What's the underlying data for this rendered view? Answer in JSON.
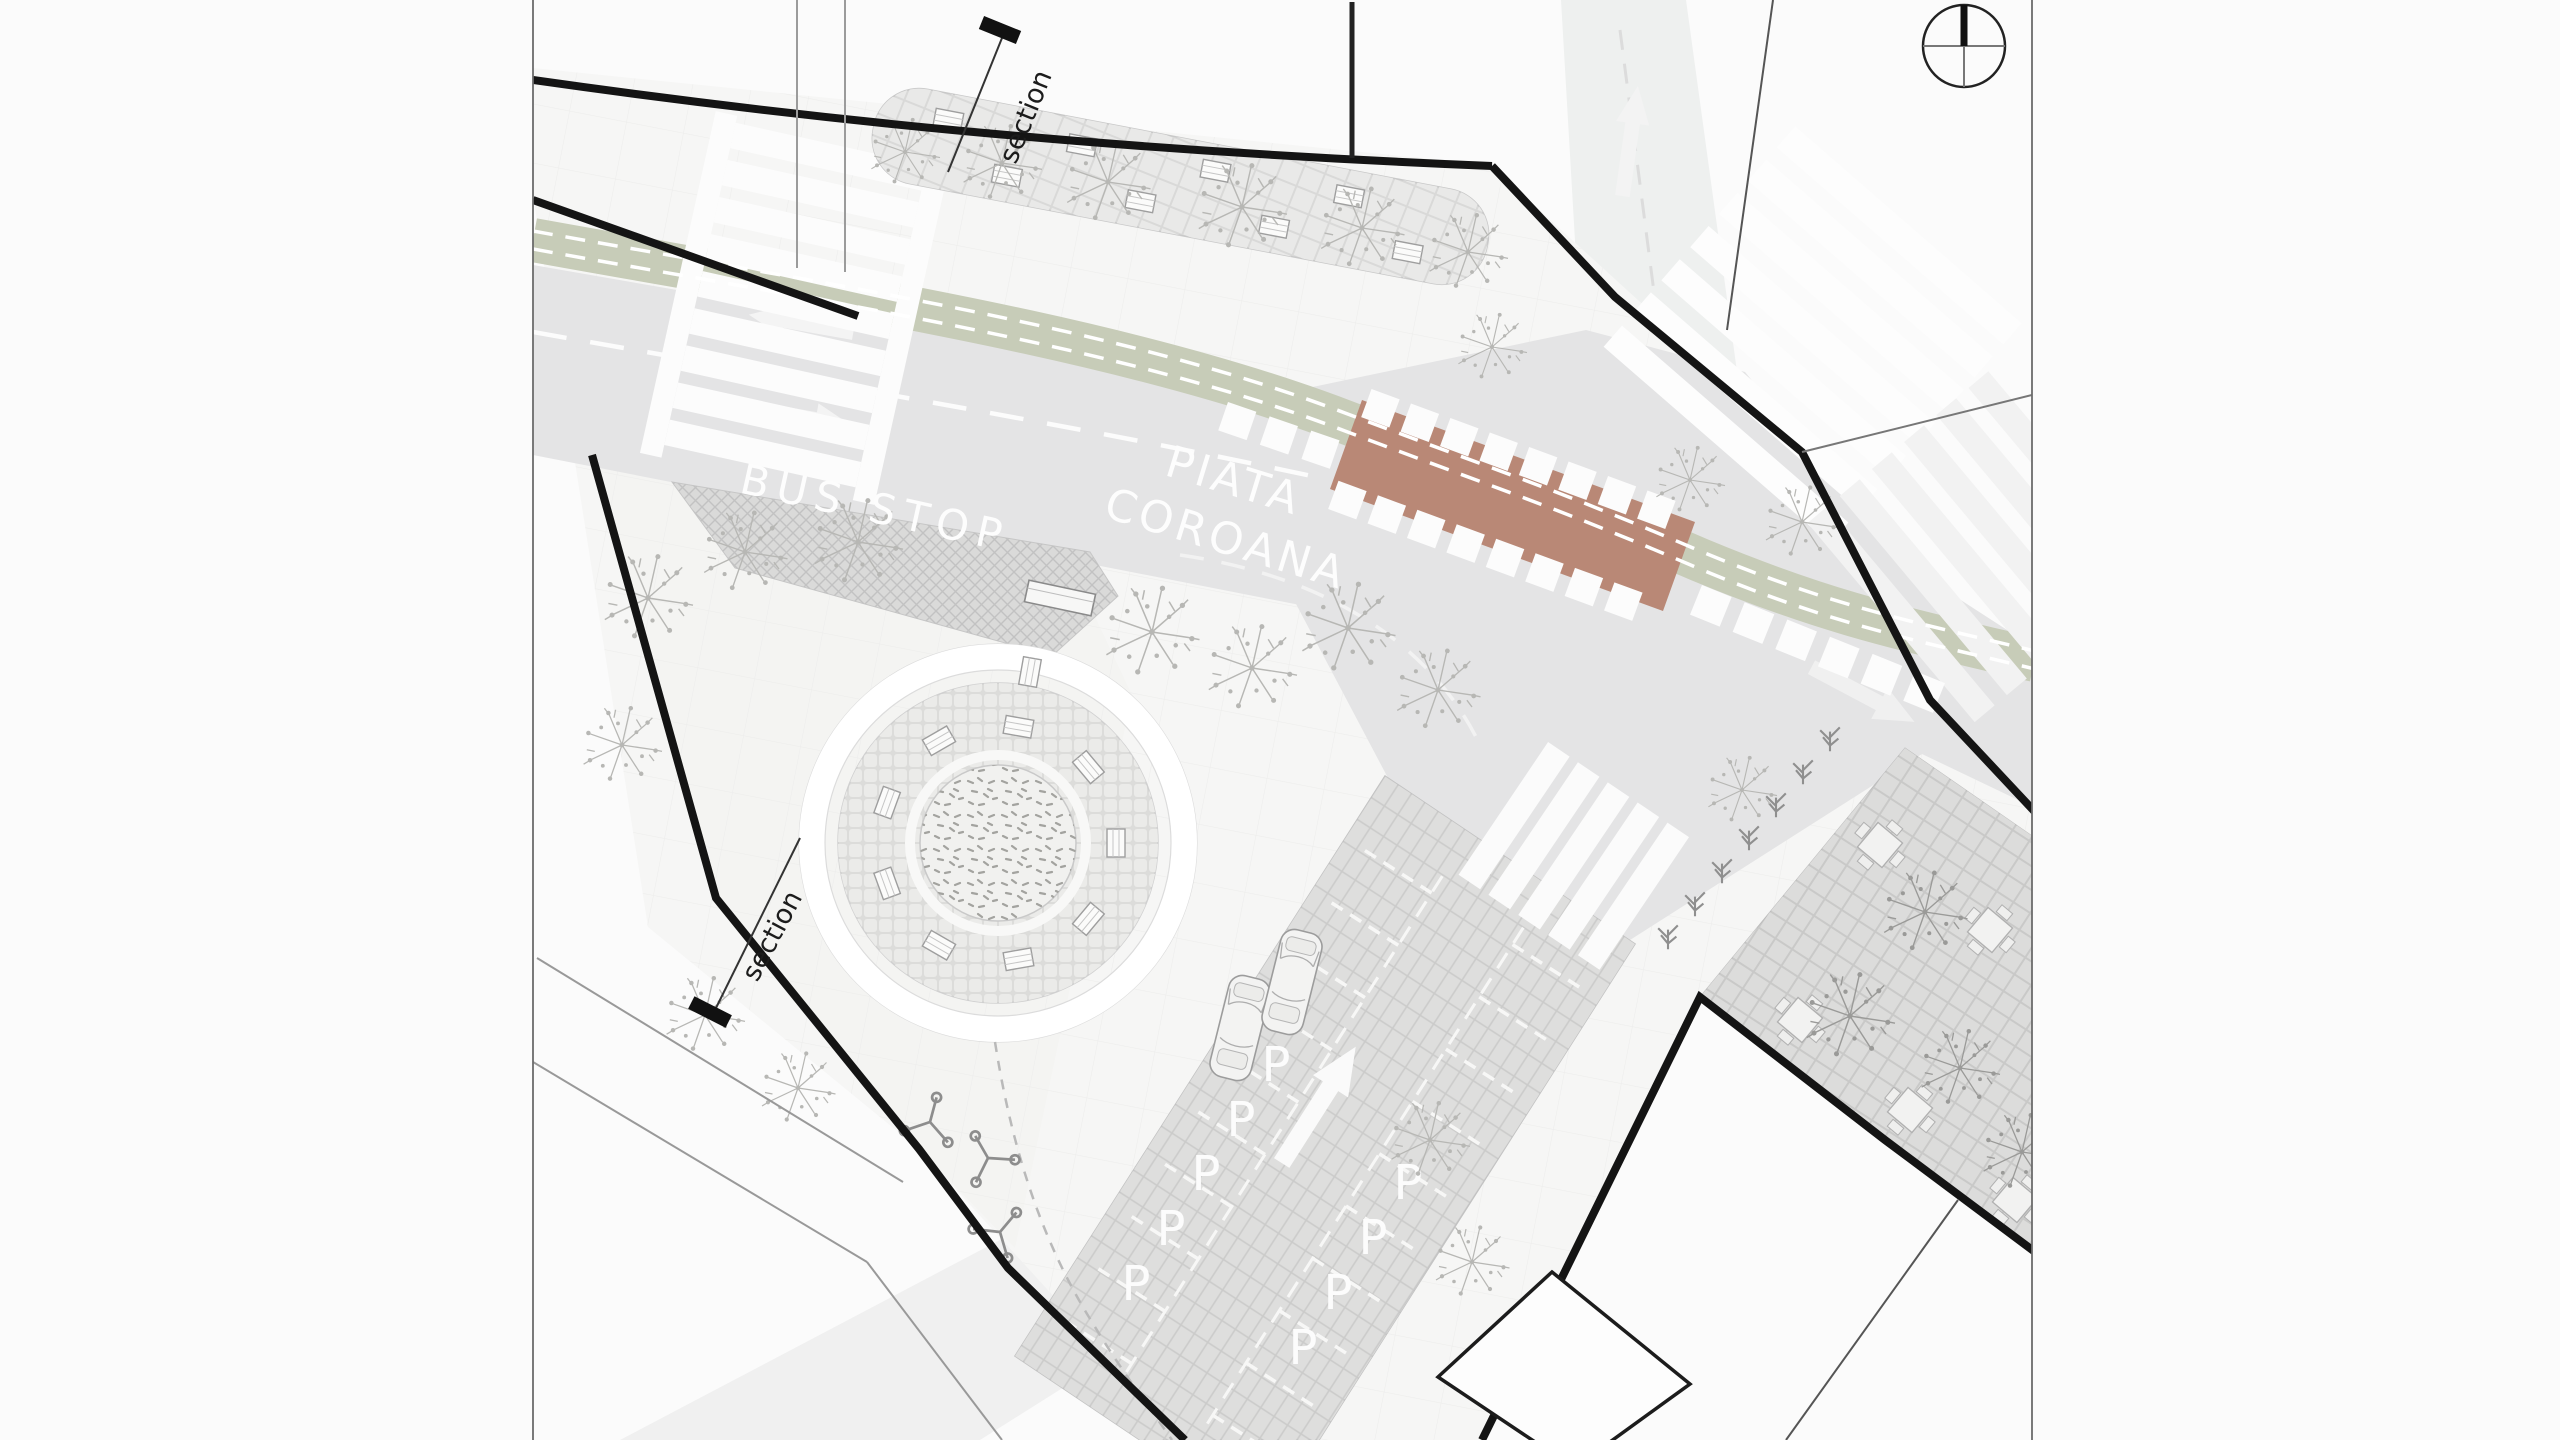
{
  "plan": {
    "labels": {
      "square_line1": "PIATA",
      "square_line2": "COROANA",
      "bus_stop": "BUS STOP",
      "parking_space": "P"
    },
    "section_markers": [
      {
        "label": "section"
      },
      {
        "label": "section"
      }
    ],
    "parking": {
      "space_count": 9,
      "cars_parked": 2,
      "aisle_arrow_direction": "up-right"
    },
    "compass": {
      "icon": "north-arrow-icon"
    },
    "arrows": [
      {
        "name": "west-lane-arrow",
        "direction": "left"
      },
      {
        "name": "east-lane-arrow",
        "direction": "right"
      },
      {
        "name": "north-road-arrow",
        "direction": "up"
      },
      {
        "name": "east-road-arrow",
        "direction": "right"
      },
      {
        "name": "parking-aisle-arrow",
        "direction": "up-right"
      }
    ],
    "icons": [
      "north-arrow-icon",
      "tree-icon",
      "car-icon",
      "bench-icon",
      "cafe-table-icon",
      "bike-rack-icon",
      "shrub-icon",
      "lane-arrow-icon",
      "section-flag-icon"
    ],
    "colors": {
      "background": "#fbfbfb",
      "sidewalk": "#f6f6f5",
      "road": "#e4e4e5",
      "bike_lane_green": "#c7ccb8",
      "raised_crossing_red": "#b98876",
      "bus_stop_paving": "#dadad9",
      "plaza_paving": "#dcdcda",
      "parking_paving": "#cbcbca",
      "terrace_paving": "#c9c9c8",
      "site_boundary": "#141414",
      "road_marking": "#fcfcfc"
    }
  }
}
